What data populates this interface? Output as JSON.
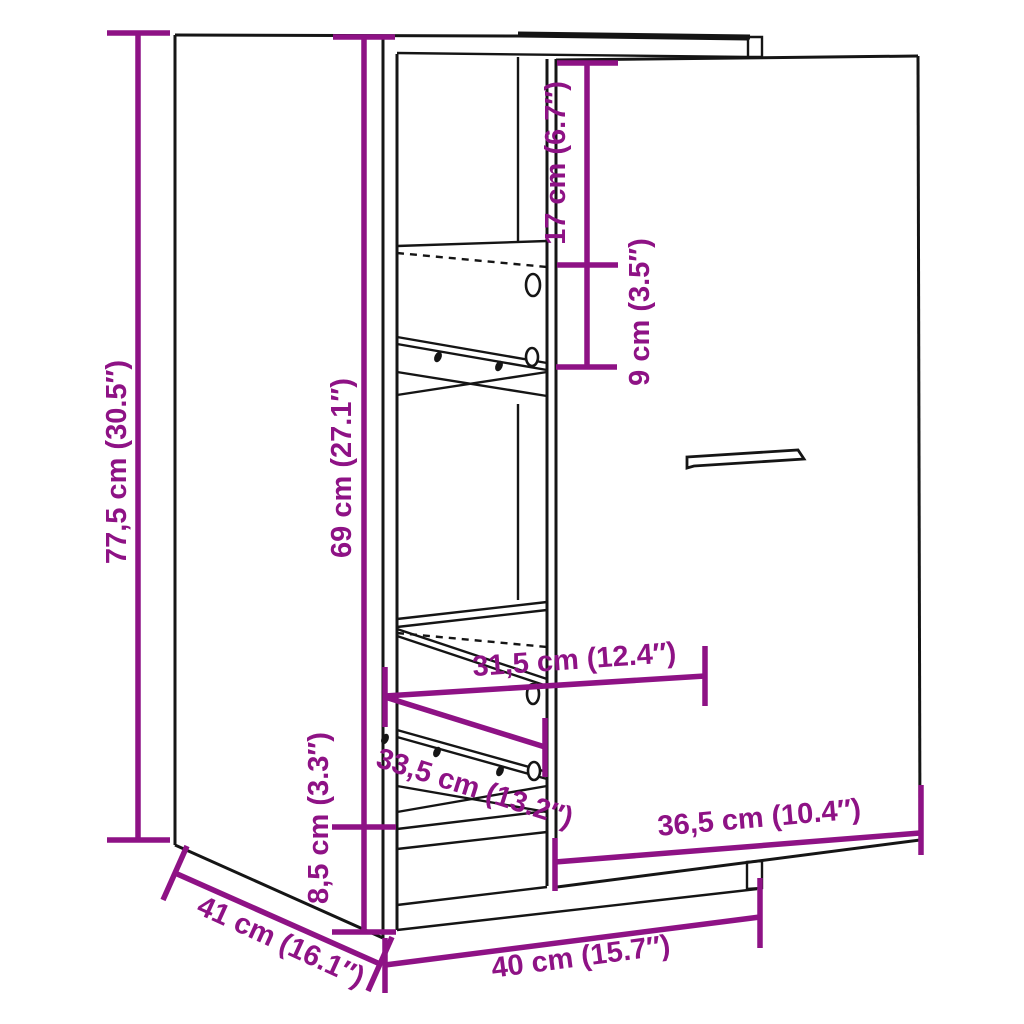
{
  "diagram": {
    "kind": "furniture-dimension-drawing",
    "subject": "narrow-apothecary-cabinet-with-pull-out-unit-and-door",
    "colors": {
      "dimension_lines": "#8e1285",
      "outline": "#151515",
      "background": "#ffffff"
    },
    "dimensions": [
      {
        "id": "total-height",
        "label": "77,5 cm (30.5″)",
        "orientation": "vertical"
      },
      {
        "id": "carcass-height",
        "label": "69 cm (27.1″)",
        "orientation": "vertical"
      },
      {
        "id": "top-inner-height",
        "label": "17 cm (6.7″)",
        "orientation": "vertical"
      },
      {
        "id": "shelf-spacing",
        "label": "9 cm (3.5″)",
        "orientation": "vertical"
      },
      {
        "id": "inner-width",
        "label": "31,5 cm (12.4″)",
        "orientation": "horizontal"
      },
      {
        "id": "drawer-depth",
        "label": "33,5 cm (13.2″)",
        "orientation": "diagonal"
      },
      {
        "id": "plinth-height",
        "label": "8,5 cm (3.3″)",
        "orientation": "vertical"
      },
      {
        "id": "depth",
        "label": "41 cm (16.1″)",
        "orientation": "diagonal"
      },
      {
        "id": "width",
        "label": "40 cm (15.7″)",
        "orientation": "horizontal"
      },
      {
        "id": "door-width",
        "label": "36,5 cm (10.4″)",
        "orientation": "horizontal"
      }
    ]
  }
}
